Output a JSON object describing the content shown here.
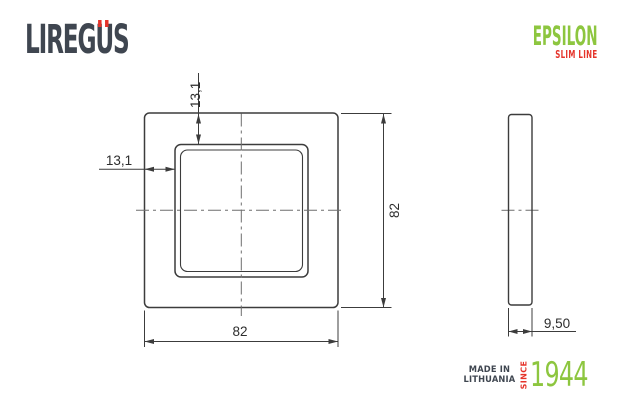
{
  "logo": {
    "prefix": "LIREG",
    "umlaut_letter": "U",
    "suffix": "S"
  },
  "brand": {
    "name": "EPSILON",
    "subline": "SLIM LINE"
  },
  "drawing": {
    "front_view": {
      "width_mm": "82",
      "height_mm": "82",
      "window_offset_left_mm": "13,1",
      "window_offset_top_mm": "13,1"
    },
    "side_view": {
      "depth_mm": "9,50"
    }
  },
  "footer": {
    "made_in_line1": "MADE IN",
    "made_in_line2": "LITHUANIA",
    "since": "SINCE",
    "year": "1944"
  },
  "colors": {
    "accent_green": "#8dc63f",
    "accent_red": "#e5332a",
    "ink": "#3f4650",
    "line": "#3c3c3c"
  }
}
